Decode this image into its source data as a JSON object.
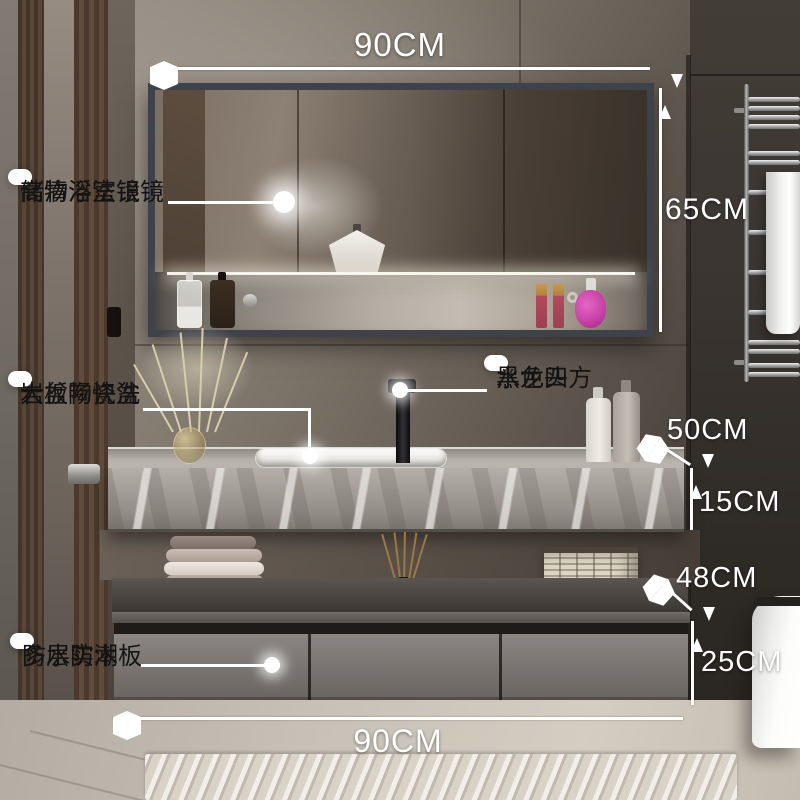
{
  "dimensions": {
    "mirror_width": "90CM",
    "mirror_height": "65CM",
    "counter_depth": "50CM",
    "counter_thickness": "15CM",
    "shelf_gap": "48CM",
    "cabinet_height": "25CM",
    "cabinet_width": "90CM"
  },
  "callouts": {
    "mirror": {
      "line1": "储物浴室镜",
      "line2": "高清浮法银镜"
    },
    "basin": {
      "line1": "岩板陶瓷盆",
      "line2": "大盆畅快洗"
    },
    "faucet": {
      "line1": "黑色四方",
      "line2": "水龙头"
    },
    "board": {
      "line1": "多层实木板",
      "line2": "防水防潮"
    }
  },
  "colors": {
    "annotation_text": "#ffffff",
    "callout_bg": "#ffffff",
    "callout_text": "#141414",
    "mirror_frame": "#3e434b",
    "counter_marble": "#a49f98",
    "cabinet_front": "#7c7774",
    "perfume_pink": "#c33ba2",
    "lipstick_red": "#b6485c"
  }
}
